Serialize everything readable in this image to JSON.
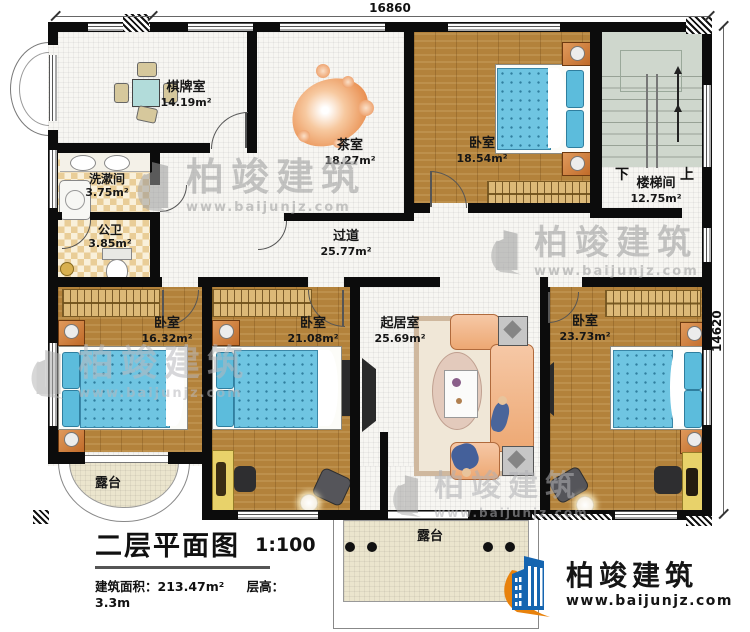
{
  "dimensions": {
    "width": "16860",
    "height": "14620"
  },
  "rooms": [
    {
      "name": "棋牌室",
      "area": "14.19m²"
    },
    {
      "name": "茶室",
      "area": "18.27m²"
    },
    {
      "name": "卧室",
      "area": "18.54m²"
    },
    {
      "name": "楼梯间",
      "area": "12.75m²"
    },
    {
      "name": "洗漱间",
      "area": "3.75m²"
    },
    {
      "name": "公卫",
      "area": "3.85m²"
    },
    {
      "name": "过道",
      "area": "25.77m²"
    },
    {
      "name": "卧室",
      "area": "16.32m²"
    },
    {
      "name": "卧室",
      "area": "21.08m²"
    },
    {
      "name": "起居室",
      "area": "25.69m²"
    },
    {
      "name": "卧室",
      "area": "23.73m²"
    }
  ],
  "terraces": [
    {
      "name": "露台"
    },
    {
      "name": "露台"
    }
  ],
  "stairs": {
    "down": "下",
    "up": "上"
  },
  "title": {
    "main": "二层平面图",
    "scale": "1:100",
    "area": "建筑面积：213.47m²",
    "floor_height": "层高：3.3m"
  },
  "brand": {
    "name": "柏竣建筑",
    "url": "www.baijunjz.com"
  },
  "watermark": {
    "name": "柏竣建筑",
    "url": "www.baijunjz.com"
  }
}
